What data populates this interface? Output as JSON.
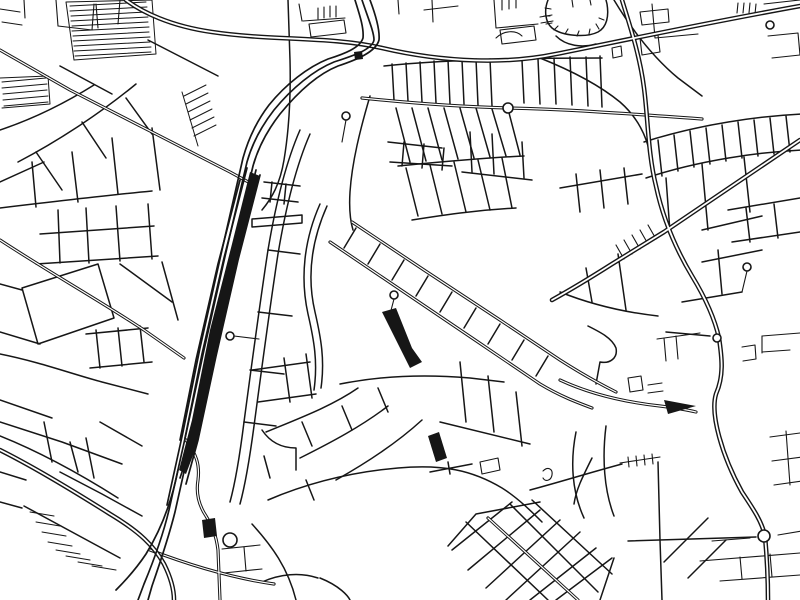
{
  "page": {
    "background": "#ffffff"
  },
  "map": {
    "kind": "black-and-white minimalist city street map",
    "colors": {
      "ink": "#161616",
      "background": "#ffffff",
      "road_core": "#ffffff"
    },
    "layers": [
      {
        "name": "minor-streets",
        "stroke": "#161616",
        "width": 1.1,
        "paths": [
          "M0,9 L20,12",
          "M2,22 L22,25",
          "M24,0 L25,18",
          "M56,0 L58,26",
          "M58,26 L92,30",
          "M92,30 L94,4",
          "M96,4 L98,28",
          "M120,0 L118,24",
          "M318,8 L318,19",
          "M324,7 L324,18",
          "M330,6 L330,17",
          "M336,6 L336,17",
          "M303,21 L345,18",
          "M302,21 L299,4",
          "M309,24 L344,20 L346,33 L311,37 Z",
          "M398,0 L399,14",
          "M424,10 L458,6",
          "M432,0 L433,22",
          "M494,0 L496,28 L538,24",
          "M502,0 L502,10",
          "M509,0 L509,9",
          "M516,0 L516,8",
          "M500,30 L534,26 L536,40 L502,44 Z",
          "M496,38 C504,30 516,30 522,36",
          "M545,8 L551,9",
          "M544,16 L550,16",
          "M546,24 L552,23",
          "M554,30 L558,26",
          "M565,34 L568,29",
          "M577,36 L579,31",
          "M589,34 L590,29",
          "M599,29 L596,24",
          "M604,20 L599,18",
          "M540,17 L552,15",
          "M541,23 L553,21",
          "M572,0 L573,7",
          "M590,0 L591,5",
          "M738,3 L737,13",
          "M744,3 L743,13",
          "M750,3 L749,13",
          "M756,4 L755,14",
          "M764,4 L800,0",
          "M768,36 L798,33 L800,55 L772,58",
          "M652,4 L655,38 L698,34",
          "M640,12 L668,9 L669,22 L642,25 Z",
          "M612,48 L621,46 L622,56 L613,58 Z",
          "M640,38 L658,35 L660,52 L642,55 Z",
          "M762,336 L800,333",
          "M762,352 L790,350",
          "M762,336 L762,353",
          "M742,347 L755,345 L756,359 L743,361",
          "M628,378 L641,376 L643,390 L630,392 Z",
          "M648,385 L662,383",
          "M648,393 L663,391",
          "M664,338 L666,361",
          "M676,336 L678,359",
          "M657,339 L700,333",
          "M770,437 L800,433",
          "M772,461 L802,457",
          "M774,485 L802,481",
          "M786,431 L790,485",
          "M700,561 L800,553",
          "M720,581 L800,575",
          "M740,557 L742,579",
          "M770,554 L772,577",
          "M712,541 L750,538",
          "M778,535 L802,531",
          "M620,463 L660,457",
          "M628,457 L629,467",
          "M636,456 L637,466",
          "M644,455 L645,465",
          "M652,454 L653,464",
          "M222,549 L260,545",
          "M224,573 L262,569",
          "M244,547 L246,571",
          "M543,471 C548,466 553,469 552,475 C551,481 545,482 543,478",
          "M480,462 L498,458 L500,470 L482,474 Z",
          "M624,240 L632,254",
          "M632,235 L640,249",
          "M640,230 L648,244",
          "M648,225 L656,239",
          "M616,245 L624,259",
          "M346,120 L342,142",
          "M394,299 L389,318",
          "M234,336 L259,339",
          "M747,271 L742,292"
        ]
      },
      {
        "name": "streets",
        "stroke": "#161616",
        "width": 1.5,
        "paths": [
          "M0,130 C30,120 62,105 94,85",
          "M18,162 C60,140 102,112 136,84",
          "M0,182 L44,162",
          "M148,40 L218,76",
          "M60,66 L112,94",
          "M36,152 L62,190",
          "M82,122 L106,158",
          "M126,98 L152,134",
          "M0,208 C50,202 100,196 152,191",
          "M32,162 L36,207",
          "M72,152 L78,202",
          "M112,138 L118,194",
          "M152,128 L160,190",
          "M58,210 L60,263",
          "M86,208 L89,263",
          "M116,206 L120,261",
          "M148,204 L152,259",
          "M40,234 L154,226",
          "M36,264 L158,256",
          "M22,288 L98,264 L114,318 L38,344 Z",
          "M0,284 L22,290",
          "M120,264 L172,302",
          "M162,262 L178,320",
          "M0,332 L40,344",
          "M0,354 C40,362 72,374 102,382 L148,394",
          "M86,334 L148,328",
          "M90,368 L152,362",
          "M96,330 L100,368",
          "M118,328 L122,366",
          "M140,326 L144,362",
          "M0,422 L62,442 L122,464",
          "M0,400 L52,418",
          "M44,422 L52,462",
          "M86,438 L94,478",
          "M60,472 L102,494 L142,516",
          "M100,422 L142,446",
          "M70,442 L78,472",
          "M0,472 L26,480",
          "M0,502 L22,508",
          "M0,436 C40,452 80,474 118,498",
          "M300,130 C286,162 276,202 268,250 C260,302 252,362 244,422 C240,454 236,480 230,502",
          "M310,134 C296,166 286,206 278,254 C270,306 262,366 254,426 C250,456 246,482 240,504",
          "M268,250 L300,254",
          "M258,312 L292,316",
          "M250,370 L284,374",
          "M244,422 L276,426",
          "M262,198 L298,202",
          "M264,182 L300,186",
          "M272,182 L270,202",
          "M286,184 L284,204",
          "M252,219 L302,215 L302,223 L252,227 Z",
          "M252,370 L310,362",
          "M258,402 L316,394",
          "M284,358 L290,402",
          "M306,354 L312,398",
          "M262,430 C270,442 282,448 296,448 L296,470",
          "M288,0 L290,60 C291,100 289,130 284,160 C280,184 272,198 262,210",
          "M370,96 C360,130 352,162 350,192 C349,208 350,220 353,230",
          "M388,142 L442,148",
          "M390,162 L452,166",
          "M404,142 L402,166",
          "M424,144 L422,168",
          "M444,148 L442,170",
          "M470,132 L472,172",
          "M492,134 L494,174",
          "M462,172 L532,180",
          "M522,142 L524,178",
          "M384,66 C440,60 520,58 602,58",
          "M392,64 L394,100",
          "M406,63 L408,101",
          "M420,62 L422,102",
          "M434,61 L436,103",
          "M448,60 L450,104",
          "M462,60 L464,104",
          "M476,59 L478,105",
          "M490,59 L492,106",
          "M522,60 L524,103",
          "M538,59 L540,104",
          "M554,58 L556,104",
          "M570,57 L572,105",
          "M586,57 L588,106",
          "M600,56 L602,107",
          "M396,108 L410,162",
          "M412,108 L426,161",
          "M428,108 L442,160",
          "M444,108 L458,159",
          "M460,108 L474,158",
          "M476,108 L490,157",
          "M492,109 L506,156",
          "M508,109 L520,155",
          "M398,166 C440,162 480,158 524,156",
          "M406,168 L418,216",
          "M430,165 L442,214",
          "M454,162 L466,212",
          "M478,160 L490,210",
          "M502,158 L512,208",
          "M412,220 C450,214 480,210 516,208",
          "M320,204 C304,240 300,278 308,314 C314,340 318,362 314,390",
          "M327,206 C311,242 307,278 315,312 C321,338 325,360 321,388",
          "M266,432 C300,418 332,406 358,388",
          "M300,458 C332,442 362,426 388,406",
          "M336,480 C368,462 398,442 422,420",
          "M302,422 L312,446",
          "M342,406 L352,430",
          "M378,388 L388,412",
          "M264,456 L270,478",
          "M306,480 L314,500",
          "M356,228 L344,248",
          "M380,244 L368,264",
          "M404,260 L392,280",
          "M428,276 L416,296",
          "M452,292 L440,312",
          "M476,308 L464,328",
          "M500,324 L488,344",
          "M524,340 L512,360",
          "M548,356 L536,376",
          "M460,362 L466,422",
          "M488,376 L494,432",
          "M516,392 L522,446",
          "M340,384 C380,376 424,374 470,378 L504,382",
          "M440,422 L530,444",
          "M588,326 C600,332 612,338 616,348 C618,358 610,364 600,362 L596,384",
          "M560,292 C590,304 622,312 658,316",
          "M586,268 L592,302",
          "M618,254 L626,310",
          "M560,188 L642,174",
          "M576,174 L580,212",
          "M600,170 L604,208",
          "M624,168 L628,204",
          "M682,302 L742,292",
          "M702,262 L762,250",
          "M718,250 L722,294",
          "M666,332 L710,336",
          "M644,142 C700,124 760,116 802,114",
          "M646,178 C700,160 760,152 802,150",
          "M658,140 L662,176",
          "M674,135 L678,171",
          "M690,131 L694,167",
          "M706,128 L710,164",
          "M722,125 L726,161",
          "M738,122 L742,158",
          "M754,120 L758,156",
          "M770,118 L774,154",
          "M786,116 L790,152",
          "M666,178 L670,232",
          "M702,164 L708,230",
          "M744,157 L750,212",
          "M702,230 L762,216",
          "M728,210 L800,198",
          "M732,242 L800,232",
          "M746,208 L750,242",
          "M774,204 L778,238",
          "M430,472 L472,464",
          "M448,462 L450,474",
          "M268,500 C310,482 352,472 398,468 C442,464 472,470 502,488 C518,498 532,512 542,522",
          "M592,458 C582,478 576,490 574,504",
          "M530,490 C560,482 592,472 622,464",
          "M576,432 C570,462 572,492 584,518",
          "M606,426 C602,458 604,490 614,516",
          "M466,522 L548,600",
          "M510,504 L598,592",
          "M532,500 L612,574",
          "M452,550 L512,502",
          "M468,570 L540,510",
          "M486,588 L560,520",
          "M506,600 L580,532",
          "M530,600 L596,548",
          "M556,600 L612,558",
          "M448,546 L476,514 L540,502",
          "M614,558 L600,600",
          "M628,541 L756,537",
          "M658,462 L660,540",
          "M660,540 L662,600",
          "M664,562 L708,518",
          "M688,578 L726,540",
          "M252,524 C272,546 288,568 296,600",
          "M262,582 C280,574 300,572 318,578",
          "M320,578 C340,586 348,596 350,600",
          "M24,506 L120,558",
          "M540,58 C570,70 598,84 620,102 C636,116 646,134 650,154",
          "M614,0 C632,30 654,58 678,78 L702,96",
          "M548,0 C544,10 545,22 552,28 C562,36 586,38 598,32 C607,27 609,16 607,4 L606,0",
          "M556,36 C566,46 582,48 596,44"
        ]
      },
      {
        "name": "hatch-blocks",
        "stroke": "#161616",
        "width": 1.0,
        "paths": [
          "M70,6 L146,2",
          "M70,11 L147,7",
          "M71,16 L147,12",
          "M71,21 L148,17",
          "M72,26 L148,22",
          "M72,31 L149,27",
          "M73,36 L149,32",
          "M73,41 L150,37",
          "M74,46 L150,42",
          "M74,51 L151,47",
          "M75,56 L151,52",
          "M66,2 L152,0 L156,54 L74,60 Z",
          "M2,82 L46,78",
          "M2,88 L47,84",
          "M3,94 L47,90",
          "M3,100 L48,96",
          "M4,106 L48,102",
          "M0,78 L48,76 L50,104 L2,108",
          "M184,96 L206,85",
          "M186,104 L208,93",
          "M188,112 L210,101",
          "M190,120 L212,109",
          "M192,128 L214,117",
          "M194,136 L216,125",
          "M182,92 L198,146",
          "M30,512 L54,516",
          "M36,522 L60,526",
          "M42,532 L66,536",
          "M48,542 L72,546",
          "M56,550 L80,554",
          "M66,556 L90,560",
          "M78,562 L102,566",
          "M92,566 L116,570"
        ]
      },
      {
        "name": "avenues",
        "stroke": "#161616",
        "width": 3.2,
        "core_width": 1.2,
        "paths": [
          "M362,98 C420,104 470,107 508,108 C560,109 620,113 702,119",
          "M0,50 L70,90 L152,132 L230,172 L252,184",
          "M0,240 C52,274 102,302 144,330 L184,358",
          "M352,222 L424,270 L500,320 L560,360 C585,376 600,384 616,392",
          "M330,242 L404,292 L478,342 L540,384 C560,396 576,402 592,408",
          "M560,380 C590,394 624,402 660,406 C676,408 688,410 696,412",
          "M186,440 C196,454 200,464 198,480 C196,492 198,504 206,516 C212,526 216,534 218,550 L220,600",
          "M150,550 C192,566 232,578 274,584",
          "M488,518 L578,600"
        ]
      },
      {
        "name": "major-roads",
        "stroke": "#161616",
        "width": 4.6,
        "core_width": 1.8,
        "paths": [
          "M126,0 C142,12 170,26 212,32 C272,41 330,36 382,48 C446,63 508,64 556,54 C616,42 700,24 800,6",
          "M622,0 C630,26 640,56 644,88 C648,118 648,154 656,186 C662,214 674,246 692,276 C706,299 715,320 719,338 C722,358 724,376 716,394 C710,414 722,456 742,492 C754,510 762,522 765,536 C767,558 768,580 768,600",
          "M800,140 L726,190 L664,232 L612,264 C590,278 570,290 552,300",
          "M0,450 C32,466 72,490 110,514 C140,532 154,546 164,564 C172,580 174,592 174,600"
        ]
      },
      {
        "name": "railway-tracks",
        "stroke": "#161616",
        "width": 1.7,
        "paths": [
          "M362,0 C368,18 374,32 374,40 C372,50 352,56 334,62 C314,70 292,88 274,110 C260,128 252,144 247,162 L226,252 L204,350 L186,434 L169,510 C163,535 154,560 144,584 L138,600",
          "M370,0 C376,16 380,30 379,40 C376,52 356,60 338,66 C318,74 298,92 280,114 C266,132 258,148 253,166 L232,254 L210,352 L192,436 L175,512 C169,536 161,560 152,586 L148,600",
          "M355,0 C360,16 364,28 363,38 C360,48 344,54 328,59 C308,67 286,84 269,105 C256,122 248,140 243,158 L222,250 L200,348 L183,432 L167,505",
          "M247,168 L224,258 L202,354 L185,438",
          "M256,170 L234,256 L212,352 L194,436 L180,478",
          "M260,175 L238,260 L216,356 L198,440 L186,484",
          "M240,180 L218,264 L196,360 L180,440",
          "M252,186 L230,268 L208,362 L192,440",
          "M178,470 C172,500 162,528 146,554 C138,566 128,578 116,590"
        ]
      },
      {
        "name": "filled-blocks",
        "stroke": "none",
        "width": 0,
        "fill": "#161616",
        "paths": [
          "M250,172 L260,176 L238,262 L216,358 L198,442 L186,474 L179,470 L192,420 L210,330 L232,244 Z",
          "M202,520 L215,518 L217,536 L204,538 Z",
          "M382,312 L396,308 L412,348 L422,362 L410,368 L398,344 Z",
          "M428,436 L439,432 L447,458 L436,462 Z",
          "M354,52 L362,51 L363,59 L355,60 Z",
          "M664,400 L696,406 L668,414 Z"
        ]
      }
    ],
    "circles": [
      {
        "name": "dead-end-loop",
        "cx": 346,
        "cy": 116,
        "r": 4
      },
      {
        "name": "dead-end-loop",
        "cx": 394,
        "cy": 295,
        "r": 4
      },
      {
        "name": "roundabout",
        "cx": 508,
        "cy": 108,
        "r": 5
      },
      {
        "name": "roundabout",
        "cx": 770,
        "cy": 25,
        "r": 4
      },
      {
        "name": "roundabout",
        "cx": 717,
        "cy": 338,
        "r": 4
      },
      {
        "name": "roundabout",
        "cx": 764,
        "cy": 536,
        "r": 6
      },
      {
        "name": "roundabout",
        "cx": 747,
        "cy": 267,
        "r": 4
      },
      {
        "name": "dead-end-loop",
        "cx": 230,
        "cy": 336,
        "r": 4
      },
      {
        "name": "pond",
        "cx": 230,
        "cy": 540,
        "r": 7
      }
    ]
  }
}
